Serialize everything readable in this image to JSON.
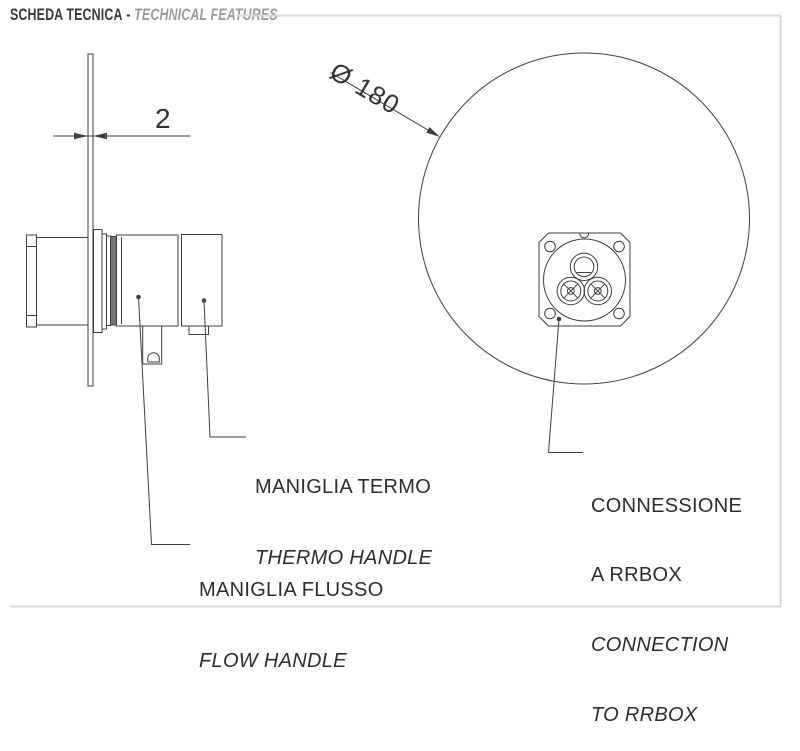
{
  "header": {
    "title_primary": "SCHEDA TECNICA",
    "separator": "-",
    "title_secondary": "TECHNICAL FEATURES"
  },
  "dimensions": {
    "plate_thickness": "2",
    "plate_diameter": "Ø 180"
  },
  "callouts": {
    "thermo_handle": {
      "it": "MANIGLIA TERMO",
      "en": "THERMO HANDLE"
    },
    "flow_handle": {
      "it": "MANIGLIA FLUSSO",
      "en": "FLOW HANDLE"
    },
    "rrbox": {
      "it_line1": "CONNESSIONE",
      "it_line2": "A RRBOX",
      "en_line1": "CONNECTION",
      "en_line2": "TO RRBOX"
    }
  },
  "colors": {
    "drawing_line": "#3f3f3f",
    "label_text": "#2d2d2d",
    "title_primary": "#3a3a3a",
    "title_secondary": "#9b9b9b",
    "page_frame": "#d8d8d8",
    "gasket_fill": "#757575"
  }
}
